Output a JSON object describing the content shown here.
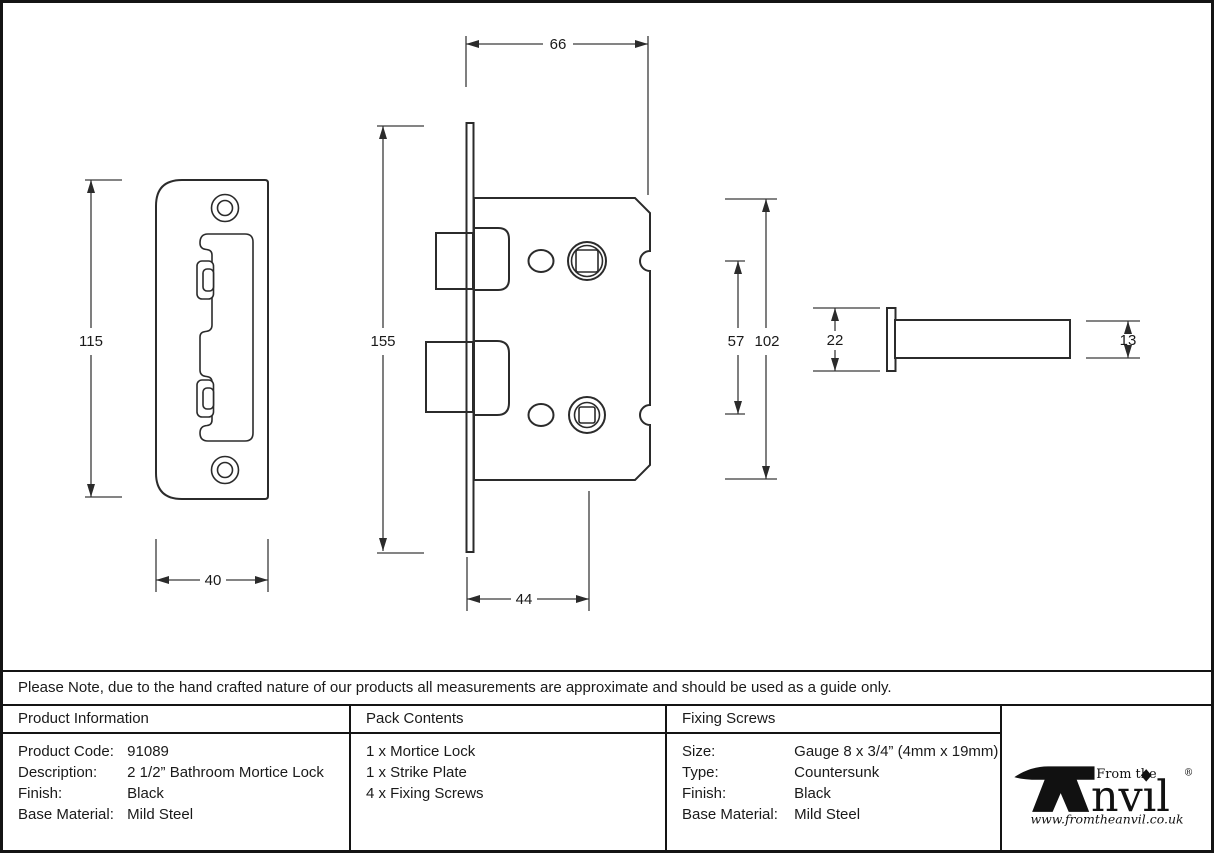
{
  "drawing": {
    "dimensions": {
      "strike_plate_height": "115",
      "strike_plate_width": "40",
      "faceplate_height": "155",
      "lock_body_width": "66",
      "backset": "44",
      "hub_spacing": "57",
      "lock_body_height": "102",
      "spindle_rose_width": "22",
      "spindle_bar_height": "13"
    }
  },
  "note": "Please Note, due to the hand crafted nature of our products all measurements are approximate and should be used as a guide only.",
  "product_information": {
    "header": "Product Information",
    "rows": [
      {
        "label": "Product Code:",
        "value": "91089"
      },
      {
        "label": "Description:",
        "value": "2 1/2” Bathroom Mortice Lock"
      },
      {
        "label": "Finish:",
        "value": "Black"
      },
      {
        "label": "Base Material:",
        "value": "Mild Steel"
      }
    ]
  },
  "pack_contents": {
    "header": "Pack Contents",
    "items": [
      "1 x Mortice Lock",
      "1 x Strike Plate",
      "4 x Fixing Screws"
    ]
  },
  "fixing_screws": {
    "header": "Fixing Screws",
    "rows": [
      {
        "label": "Size:",
        "value": "Gauge 8 x 3/4” (4mm x 19mm)"
      },
      {
        "label": "Type:",
        "value": "Countersunk"
      },
      {
        "label": "Finish:",
        "value": "Black"
      },
      {
        "label": "Base Material:",
        "value": "Mild Steel"
      }
    ]
  },
  "logo": {
    "from_the": "From the",
    "wordmark": "nvıl",
    "registered": "®",
    "website": "www.fromtheanvil.co.uk"
  }
}
